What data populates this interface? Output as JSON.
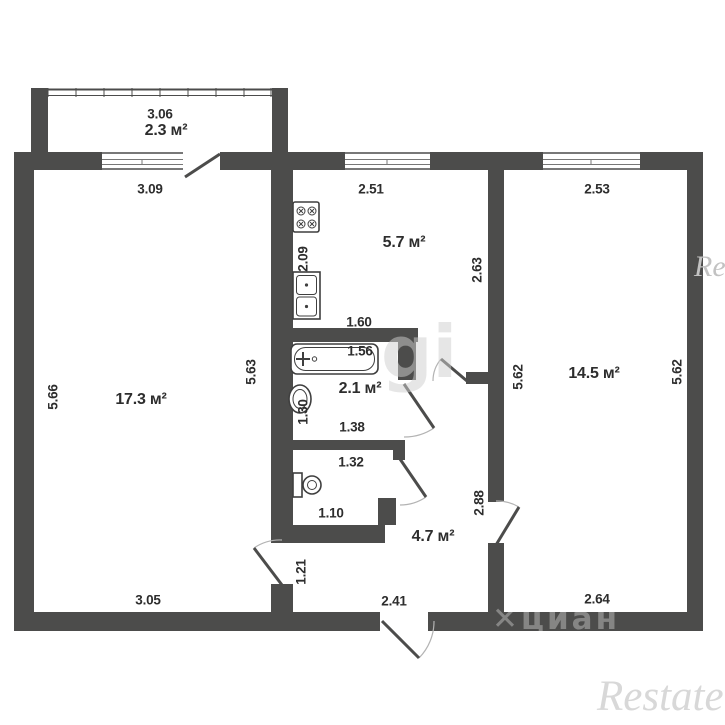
{
  "areas": {
    "balcony": "2.3 м²",
    "kitchen": "5.7 м²",
    "left_room": "17.3 м²",
    "bathroom": "2.1 м²",
    "hallway": "4.7 м²",
    "right_room": "14.5 м²"
  },
  "dims": {
    "balcony_width": "3.06",
    "left_window": "3.09",
    "kitchen_window": "2.51",
    "right_window": "2.53",
    "kitchen_left": "2.09",
    "kitchen_right": "2.63",
    "bath_width": "1.60",
    "tub": "1.56",
    "left_room_left": "5.66",
    "left_room_right": "5.63",
    "basin": "1.30",
    "bath_bottom": "1.38",
    "toilet_top": "1.32",
    "toilet_bottom": "1.10",
    "hall_right": "2.88",
    "hall_door": "1.21",
    "hall_bottom": "2.41",
    "left_room_bottom": "3.05",
    "right_room_left": "5.62",
    "right_room_right": "5.62",
    "right_room_bottom": "2.64"
  },
  "watermarks": {
    "photo": "gi",
    "cian_mark": "✕",
    "cian": "циан",
    "restate": "Restate",
    "restate_edge": "Restate"
  },
  "colors": {
    "wall": "#4c4c4b",
    "text": "#2d2d2d"
  }
}
